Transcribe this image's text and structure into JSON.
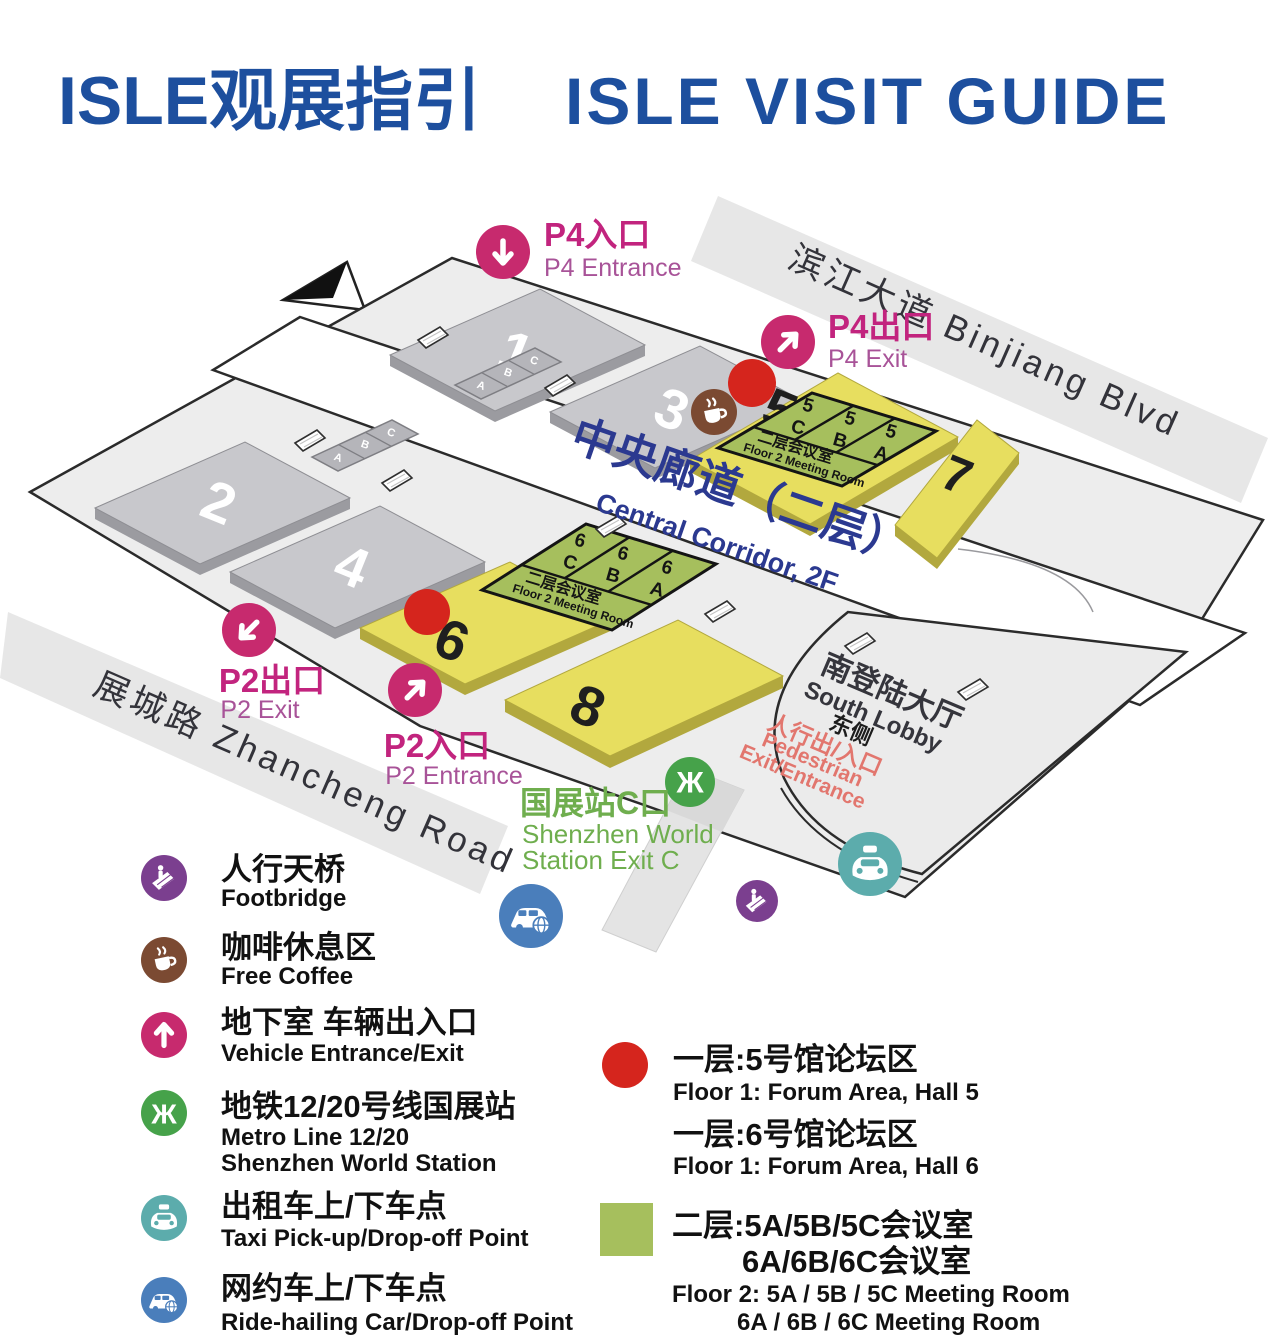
{
  "title": {
    "cn": "ISLE观展指引",
    "en": "ISLE VISIT GUIDE"
  },
  "roads": {
    "binjiang": "滨江大道 Binjiang Blvd",
    "zhancheng": "展城路 Zhancheng Road"
  },
  "compass_label": "N",
  "halls": {
    "h1": "1",
    "h2": "2",
    "h3": "3",
    "h4": "4",
    "h5": "5",
    "h6": "6",
    "h7": "7",
    "h8": "8"
  },
  "small_rooms": {
    "a": "A",
    "b": "B",
    "c": "C"
  },
  "corridor": {
    "cn": "中央廊道（二层）",
    "en": "Central Corridor, 2F"
  },
  "meeting_block_label": {
    "cn": "二层会议室",
    "en": "Floor 2 Meeting Room"
  },
  "block5": {
    "c1_num": "5",
    "c1_letter": "C",
    "c2_num": "5",
    "c2_letter": "B",
    "c3_num": "5",
    "c3_letter": "A"
  },
  "block6": {
    "c1_num": "6",
    "c1_letter": "C",
    "c2_num": "6",
    "c2_letter": "B",
    "c3_num": "6",
    "c3_letter": "A"
  },
  "markers": {
    "p4_entrance": {
      "cn": "P4入口",
      "en": "P4 Entrance"
    },
    "p4_exit": {
      "cn": "P4出口",
      "en": "P4 Exit"
    },
    "p2_exit": {
      "cn": "P2出口",
      "en": "P2 Exit"
    },
    "p2_entrance": {
      "cn": "P2入口",
      "en": "P2 Entrance"
    }
  },
  "station": {
    "cn": "国展站C口",
    "en1": "Shenzhen World",
    "en2": "Station Exit C"
  },
  "south_lobby": {
    "cn": "南登陆大厅",
    "en": "South Lobby",
    "east": "东侧",
    "ped_cn": "人行出/入口",
    "ped_en1": "Pedestrian",
    "ped_en2": "Exit/Entrance"
  },
  "legend_left": [
    {
      "cn": "人行天桥",
      "en": "Footbridge"
    },
    {
      "cn": "咖啡休息区",
      "en": "Free Coffee"
    },
    {
      "cn": "地下室 车辆出入口",
      "en": "Vehicle Entrance/Exit"
    },
    {
      "cn": "地铁12/20号线国展站",
      "en": "Metro Line 12/20",
      "en2": "Shenzhen World Station"
    },
    {
      "cn": "出租车上/下车点",
      "en": "Taxi Pick-up/Drop-off Point"
    },
    {
      "cn": "网约车上/下车点",
      "en": "Ride-hailing Car/Drop-off Point"
    }
  ],
  "legend_right": {
    "forum5_cn": "一层:5号馆论坛区",
    "forum5_en": "Floor 1: Forum Area, Hall 5",
    "forum6_cn": "一层:6号馆论坛区",
    "forum6_en": "Floor 1: Forum Area, Hall 6",
    "meeting_cn1": "二层:5A/5B/5C会议室",
    "meeting_cn2": "6A/6B/6C会议室",
    "meeting_en1": "Floor 2: 5A / 5B / 5C Meeting Room",
    "meeting_en2": "6A / 6B / 6C Meeting Room"
  },
  "colors": {
    "title_blue": "#1d4f9e",
    "magenta": "#c72a6e",
    "p_text_cn": "#c2247e",
    "p_text_en": "#a85398",
    "red_dot": "#d5251d",
    "hall_yellow": "#e7de5f",
    "hall_gray": "#c8c8cc",
    "meeting_green": "#a6bf5d",
    "metro_green": "#46a24a",
    "station_text_green": "#6fae4e",
    "taxi_teal": "#5cacac",
    "ridehail_blue": "#4a7ebb",
    "footbridge_purple": "#7b3f8f",
    "coffee_brown": "#7b4a32",
    "corridor_navy": "#2b3990",
    "ped_red": "#e2766e"
  }
}
